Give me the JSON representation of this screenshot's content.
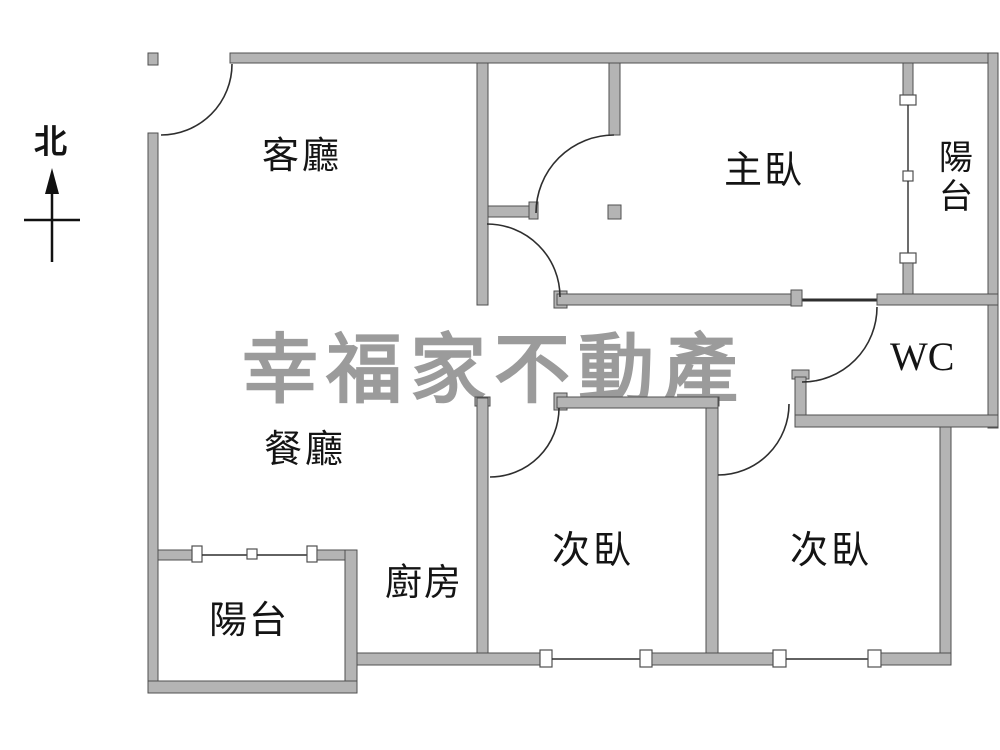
{
  "plan": {
    "title": "apartment-floor-plan",
    "north_label": "北",
    "watermark": "幸福家不動產",
    "rooms": {
      "living": "客廳",
      "master_bedroom": "主臥",
      "balcony_top_right": "陽台",
      "wc": "WC",
      "dining": "餐廳",
      "kitchen": "廚房",
      "bedroom2_left": "次臥",
      "bedroom2_right": "次臥",
      "balcony_bottom_left": "陽台"
    },
    "colors": {
      "wall_fill": "#b4b4b4",
      "wall_stroke": "#4f4f4f",
      "line": "#2e2e2e",
      "watermark": "#9b9b9b",
      "text": "#141414",
      "background": "#ffffff"
    }
  }
}
